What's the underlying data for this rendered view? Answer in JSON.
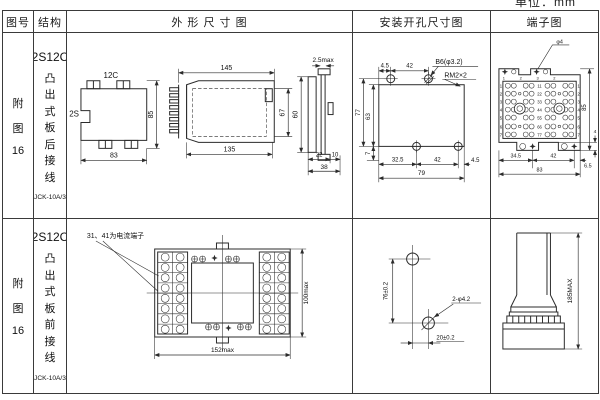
{
  "page": {
    "unit_label": "单位：mm"
  },
  "header": {
    "fig_no": "图号",
    "structure": "结构",
    "outline": "外 形 尺 寸 图",
    "mounting": "安装开孔尺寸图",
    "terminal": "端子图"
  },
  "rows": [
    {
      "fig_chars": [
        "附",
        "图",
        "16"
      ],
      "structure": {
        "model": "2S12C",
        "mount_chars": [
          "凸",
          "出",
          "式",
          "板",
          "后",
          "接",
          "线"
        ],
        "product": "JCK-10A/3"
      },
      "outline": {
        "front": {
          "top": "12C",
          "side": "2S",
          "height": "85",
          "width": "83"
        },
        "side": {
          "top": "145",
          "bottom": "135",
          "height": "67"
        },
        "panel": {
          "gap": "2.5max",
          "height": "60",
          "d22": "22",
          "d10": "10",
          "d38": "38"
        }
      },
      "mounting": {
        "t45": "4.5",
        "t42": "42",
        "hole_label": "B6(φ3.2)",
        "thread_label": "RM2×2",
        "h77": "77",
        "h63": "63",
        "b7": "7",
        "b325": "32.5",
        "b42": "42",
        "b45": "4.5",
        "b79": "79"
      },
      "terminal": {
        "callout": "φ4",
        "top_labels": [
          "1",
          "2",
          "3",
          "2"
        ],
        "left_numbers": [
          "1",
          "2",
          "3",
          "4",
          "5",
          "6",
          "7"
        ],
        "center_numbers": [
          "11",
          "22",
          "33",
          "44",
          "55",
          "66",
          "77"
        ],
        "right_numbers": [
          "1",
          "2",
          "3",
          "4",
          "5",
          "6",
          "7"
        ],
        "b345": "34.5",
        "b42": "42",
        "b65": "6.5",
        "b83": "83",
        "r85": "85",
        "r4": "4"
      }
    },
    {
      "fig_chars": [
        "附",
        "图",
        "16"
      ],
      "structure": {
        "model": "2S12C",
        "mount_chars": [
          "凸",
          "出",
          "式",
          "板",
          "前",
          "接",
          "线"
        ],
        "product": "JCK-10A/3"
      },
      "outline": {
        "note": "31、41为电流端子",
        "width": "152max",
        "height": "100max"
      },
      "mounting": {
        "v": "76±0.2",
        "h": "20±0.2",
        "holes_label": "2-φ4.2"
      },
      "terminal": {
        "height": "185MAX"
      }
    }
  ]
}
